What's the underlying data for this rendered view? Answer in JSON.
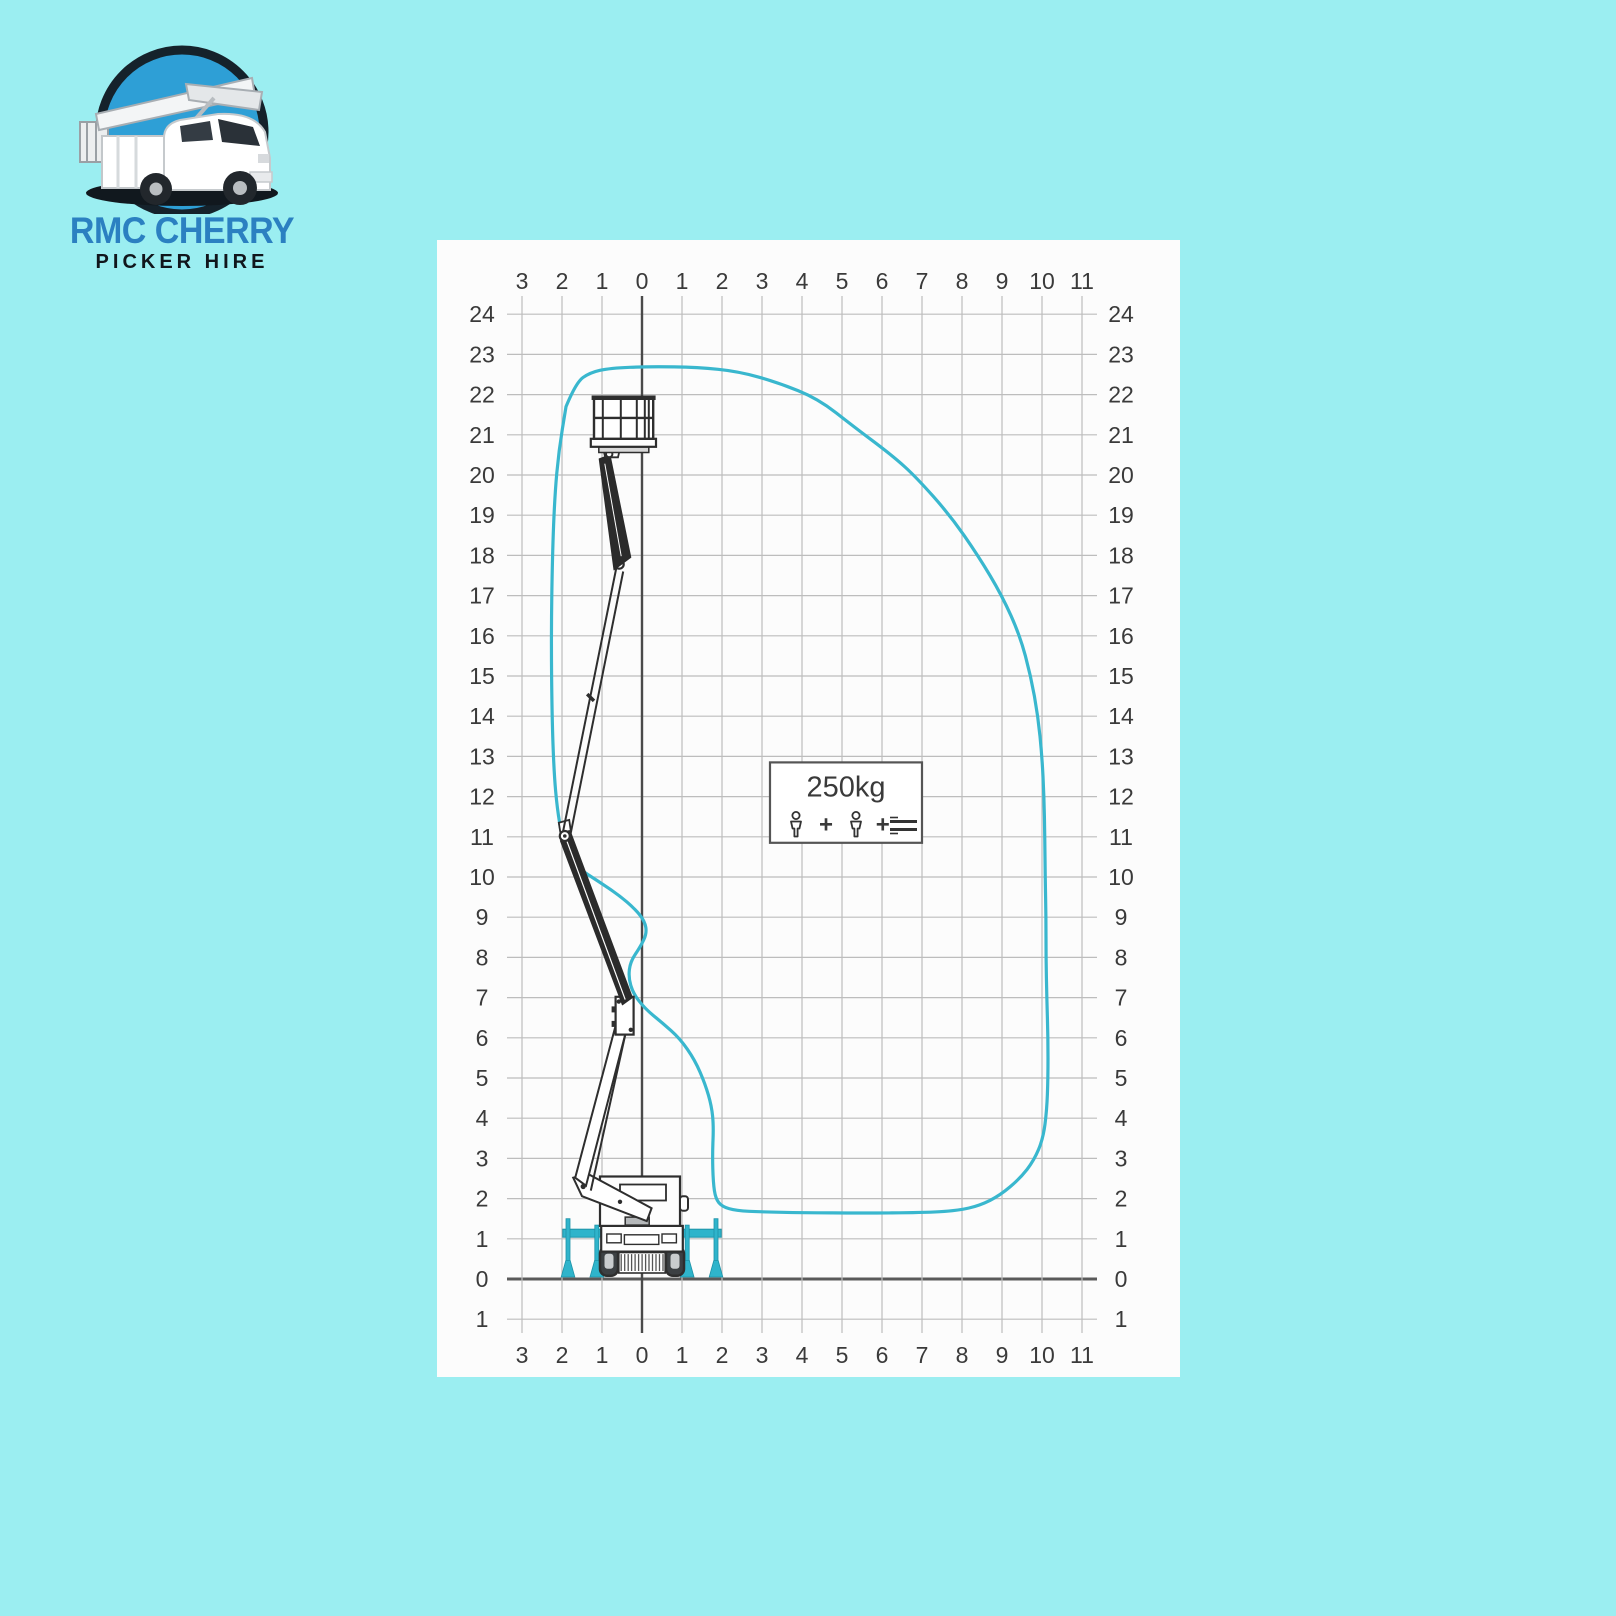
{
  "logo": {
    "line1": "RMC CHERRY",
    "line2": "PICKER HIRE"
  },
  "colors": {
    "page_background": "#9beef1",
    "envelope_stroke": "#39b7ce",
    "outrigger_teal": "#2fb4cb",
    "outrigger_teal_dark": "#1d93a8",
    "logo_blue": "#2b80c1",
    "logo_circle_blue": "#2e9fd6",
    "axis_dark": "#4a4a4a",
    "grid_gray": "#bdbdbd",
    "label_gray": "#3a3a3a",
    "machine_dark": "#2e2e2e"
  },
  "chart_data": {
    "type": "line",
    "title": "",
    "xlabel": "",
    "ylabel": "",
    "x_range": [
      -3,
      11
    ],
    "y_range": [
      -1,
      24
    ],
    "grid": true,
    "x_ticks": [
      "3",
      "2",
      "1",
      "0",
      "1",
      "2",
      "3",
      "4",
      "5",
      "6",
      "7",
      "8",
      "9",
      "10",
      "11"
    ],
    "y_ticks": [
      "24",
      "23",
      "22",
      "21",
      "20",
      "19",
      "18",
      "17",
      "16",
      "15",
      "14",
      "13",
      "12",
      "11",
      "10",
      "9",
      "8",
      "7",
      "6",
      "5",
      "4",
      "3",
      "2",
      "1",
      "0",
      "1"
    ],
    "max_height_m": 22.7,
    "max_outreach_m": 10.15,
    "envelope_points": [
      [
        -1.9,
        21.7
      ],
      [
        -1.65,
        22.3
      ],
      [
        -1.3,
        22.55
      ],
      [
        -0.8,
        22.66
      ],
      [
        0.2,
        22.7
      ],
      [
        1.4,
        22.68
      ],
      [
        2.4,
        22.58
      ],
      [
        3.4,
        22.3
      ],
      [
        4.4,
        21.9
      ],
      [
        5.3,
        21.2
      ],
      [
        6.3,
        20.45
      ],
      [
        6.85,
        19.95
      ],
      [
        7.7,
        19.0
      ],
      [
        8.4,
        18.0
      ],
      [
        9.0,
        17.0
      ],
      [
        9.45,
        16.0
      ],
      [
        9.72,
        15.0
      ],
      [
        9.9,
        14.0
      ],
      [
        10.0,
        13.0
      ],
      [
        10.05,
        12.0
      ],
      [
        10.07,
        11.0
      ],
      [
        10.08,
        10.0
      ],
      [
        10.1,
        9.0
      ],
      [
        10.1,
        8.0
      ],
      [
        10.12,
        7.0
      ],
      [
        10.15,
        6.0
      ],
      [
        10.15,
        5.0
      ],
      [
        10.12,
        4.2
      ],
      [
        10.03,
        3.5
      ],
      [
        9.8,
        2.95
      ],
      [
        9.45,
        2.5
      ],
      [
        8.95,
        2.08
      ],
      [
        8.45,
        1.83
      ],
      [
        7.9,
        1.7
      ],
      [
        7.0,
        1.65
      ],
      [
        5.5,
        1.64
      ],
      [
        4.0,
        1.65
      ],
      [
        3.0,
        1.67
      ],
      [
        2.35,
        1.7
      ],
      [
        2.0,
        1.8
      ],
      [
        1.84,
        2.0
      ],
      [
        1.78,
        2.4
      ],
      [
        1.76,
        3.1
      ],
      [
        1.79,
        3.8
      ],
      [
        1.74,
        4.3
      ],
      [
        1.58,
        4.85
      ],
      [
        1.32,
        5.45
      ],
      [
        0.95,
        5.98
      ],
      [
        0.5,
        6.38
      ],
      [
        0.08,
        6.72
      ],
      [
        -0.22,
        7.1
      ],
      [
        -0.34,
        7.5
      ],
      [
        -0.29,
        7.9
      ],
      [
        -0.03,
        8.28
      ],
      [
        0.12,
        8.6
      ],
      [
        0.07,
        8.9
      ],
      [
        -0.17,
        9.2
      ],
      [
        -0.58,
        9.55
      ],
      [
        -1.1,
        9.9
      ],
      [
        -1.6,
        10.22
      ],
      [
        -1.9,
        10.55
      ],
      [
        -2.0,
        11.0
      ],
      [
        -2.12,
        11.7
      ],
      [
        -2.2,
        12.6
      ],
      [
        -2.25,
        14.0
      ],
      [
        -2.27,
        16.0
      ],
      [
        -2.24,
        18.0
      ],
      [
        -2.18,
        19.5
      ],
      [
        -2.08,
        20.6
      ],
      [
        -1.9,
        21.7
      ]
    ],
    "sign": {
      "capacity": "250kg",
      "plus": "+"
    }
  }
}
